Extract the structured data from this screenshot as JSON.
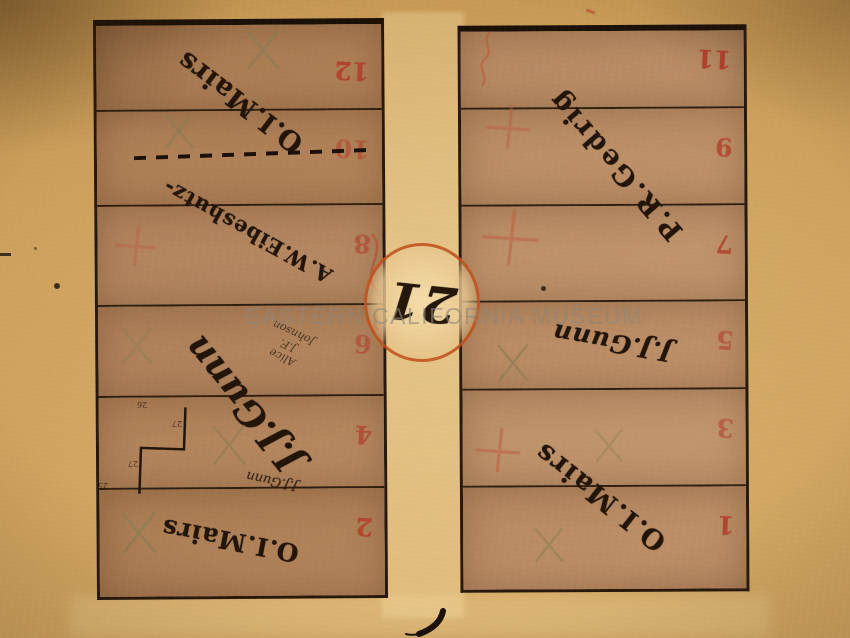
{
  "photo": {
    "watermark_text": "EASTERN CALIFORNIA MUSEUM"
  },
  "block": {
    "number": "21"
  },
  "left_block": {
    "lot_numbers": [
      "12",
      "10",
      "8",
      "6",
      "4",
      "2"
    ],
    "owners": {
      "mairs_top": "O.I.Mairs",
      "eibeshutz": "A.W.Eibeshutz-",
      "gunn_large": "J.J.Gunn",
      "gunn_small": "J.J.Gunn",
      "mairs_bottom": "O.I.Mairs"
    },
    "pencil_note": {
      "line1": "Alice",
      "line2": "J.F.",
      "line3": "Johnson"
    },
    "measurements": {
      "m1": "26",
      "m2": "27",
      "m3": "27",
      "m4": "25"
    }
  },
  "right_block": {
    "lot_numbers": [
      "11",
      "9",
      "7",
      "5",
      "3",
      "1"
    ],
    "owners": {
      "gedrig": "P.R.Gedrig",
      "gunn": "J.J.Gunn",
      "mairs": "O.I.Mairs"
    }
  },
  "colors": {
    "paper": "#cb9d58",
    "block_wash": "#b2845c",
    "ink": "#221508",
    "red_number": "#b23b28",
    "red_circle": "#c14d18",
    "pencil": "#8a7d55",
    "red_pencil": "#bf5d40",
    "watermark": "#8e8678"
  }
}
